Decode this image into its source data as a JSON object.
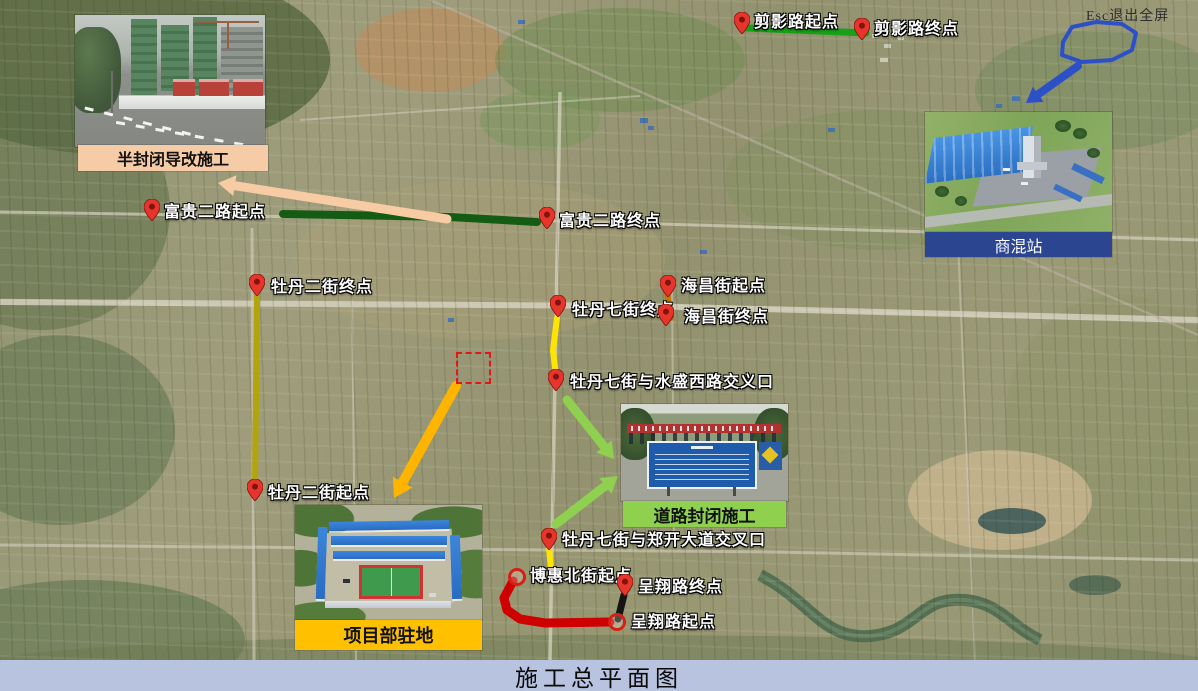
{
  "title": "施工总平面图",
  "fullscreen_hint": "Esc退出全屏",
  "title_bar_color": "#B8C3DF",
  "callouts": {
    "half_closure": {
      "label": "半封闭导改施工",
      "bar_color": "#F6CCA6"
    },
    "road_closure": {
      "label": "道路封闭施工",
      "bar_color": "#8FD14F"
    },
    "project_camp": {
      "label": "项目部驻地",
      "bar_color": "#FFC000"
    },
    "mixing_station": {
      "label": "商混站",
      "bar_color": "#2B4590"
    }
  },
  "map": {
    "routes": [
      {
        "name": "剪影路",
        "color": "#18A018",
        "width": 7,
        "points": [
          [
            747,
            28
          ],
          [
            866,
            33
          ]
        ]
      },
      {
        "name": "富贵二路",
        "color": "#145C14",
        "width": 8,
        "points": [
          [
            283,
            214
          ],
          [
            450,
            217
          ],
          [
            537,
            222
          ]
        ]
      },
      {
        "name": "牡丹二街",
        "color": "#B1A40C",
        "width": 6,
        "points": [
          [
            257,
            297
          ],
          [
            255,
            487
          ]
        ]
      },
      {
        "name": "牡丹七街",
        "color": "#FFE400",
        "width": 6,
        "points": [
          [
            557,
            318
          ],
          [
            553,
            350
          ],
          [
            556,
            377
          ]
        ]
      },
      {
        "name": "海昌街",
        "color": "#C67600",
        "width": 6,
        "points": [
          [
            667,
            292
          ],
          [
            671,
            318
          ]
        ]
      },
      {
        "name": "牡丹七街南段",
        "color": "#FFE400",
        "width": 6,
        "points": [
          [
            549,
            548
          ],
          [
            551,
            569
          ]
        ]
      },
      {
        "name": "博惠北街",
        "color": "#CF0000",
        "width": 9,
        "points": [
          [
            513,
            581
          ],
          [
            504,
            598
          ],
          [
            507,
            610
          ],
          [
            520,
            619
          ],
          [
            545,
            623
          ],
          [
            610,
            622
          ]
        ]
      },
      {
        "name": "呈翔路",
        "color": "#141414",
        "width": 7,
        "points": [
          [
            624,
            595
          ],
          [
            618,
            619
          ]
        ]
      }
    ],
    "markers": [
      {
        "type": "pin",
        "x": 742,
        "y": 34,
        "lx": 754,
        "ly": 14,
        "text": "剪影路起点"
      },
      {
        "type": "pin",
        "x": 862,
        "y": 40,
        "lx": 874,
        "ly": 21,
        "text": "剪影路终点"
      },
      {
        "type": "pin",
        "x": 152,
        "y": 221,
        "lx": 164,
        "ly": 204,
        "text": "富贵二路起点"
      },
      {
        "type": "pin",
        "x": 547,
        "y": 229,
        "lx": 559,
        "ly": 213,
        "text": "富贵二路终点"
      },
      {
        "type": "pin",
        "x": 257,
        "y": 296,
        "lx": 271,
        "ly": 279,
        "text": "牡丹二街终点"
      },
      {
        "type": "pin",
        "x": 255,
        "y": 501,
        "lx": 268,
        "ly": 485,
        "text": "牡丹二街起点"
      },
      {
        "type": "pin",
        "x": 558,
        "y": 317,
        "lx": 572,
        "ly": 302,
        "text": "牡丹七街终点"
      },
      {
        "type": "pin",
        "x": 556,
        "y": 391,
        "lx": 570,
        "ly": 374,
        "text": "牡丹七街与水盛西路交义口"
      },
      {
        "type": "pin",
        "x": 668,
        "y": 297,
        "lx": 681,
        "ly": 278,
        "text": "海昌街起点"
      },
      {
        "type": "pin",
        "x": 666,
        "y": 326,
        "lx": 684,
        "ly": 309,
        "text": "海昌街终点"
      },
      {
        "type": "pin",
        "x": 549,
        "y": 550,
        "lx": 562,
        "ly": 532,
        "text": "牡丹七街与郑开大道交叉口"
      },
      {
        "type": "ring",
        "x": 517,
        "y": 577,
        "lx": 530,
        "ly": 568,
        "text": "博惠北街起点"
      },
      {
        "type": "pin",
        "x": 625,
        "y": 596,
        "lx": 638,
        "ly": 579,
        "text": "呈翔路终点"
      },
      {
        "type": "ring",
        "x": 617,
        "y": 622,
        "lx": 631,
        "ly": 614,
        "text": "呈翔路起点"
      }
    ],
    "arrows": [
      {
        "id": "half-closure-pointer",
        "color": "#F7CBA4",
        "width": 9,
        "head": 17,
        "from": [
          447,
          219
        ],
        "to": [
          218,
          183
        ]
      },
      {
        "id": "camp-pointer",
        "color": "#FFB400",
        "width": 10,
        "head": 18,
        "from": [
          456,
          386
        ],
        "to": [
          394,
          498
        ]
      },
      {
        "id": "closure-pointer-1",
        "color": "#8FD050",
        "width": 9,
        "head": 16,
        "from": [
          567,
          400
        ],
        "to": [
          614,
          459
        ]
      },
      {
        "id": "closure-pointer-2",
        "color": "#8FD050",
        "width": 9,
        "head": 16,
        "from": [
          556,
          524
        ],
        "to": [
          618,
          476
        ]
      },
      {
        "id": "station-pointer",
        "color": "#2B50C8",
        "width": 8,
        "head": 15,
        "from": [
          1078,
          66
        ],
        "to": [
          1026,
          103
        ]
      }
    ],
    "region_loop": {
      "color": "#2B50C8",
      "width": 4,
      "points": [
        [
          1063,
          42
        ],
        [
          1072,
          27
        ],
        [
          1096,
          22
        ],
        [
          1122,
          24
        ],
        [
          1136,
          33
        ],
        [
          1132,
          50
        ],
        [
          1112,
          60
        ],
        [
          1082,
          62
        ],
        [
          1062,
          55
        ]
      ]
    },
    "dashed_box": {
      "x": 456,
      "y": 352,
      "w": 31,
      "h": 28,
      "color": "#E21717"
    }
  }
}
